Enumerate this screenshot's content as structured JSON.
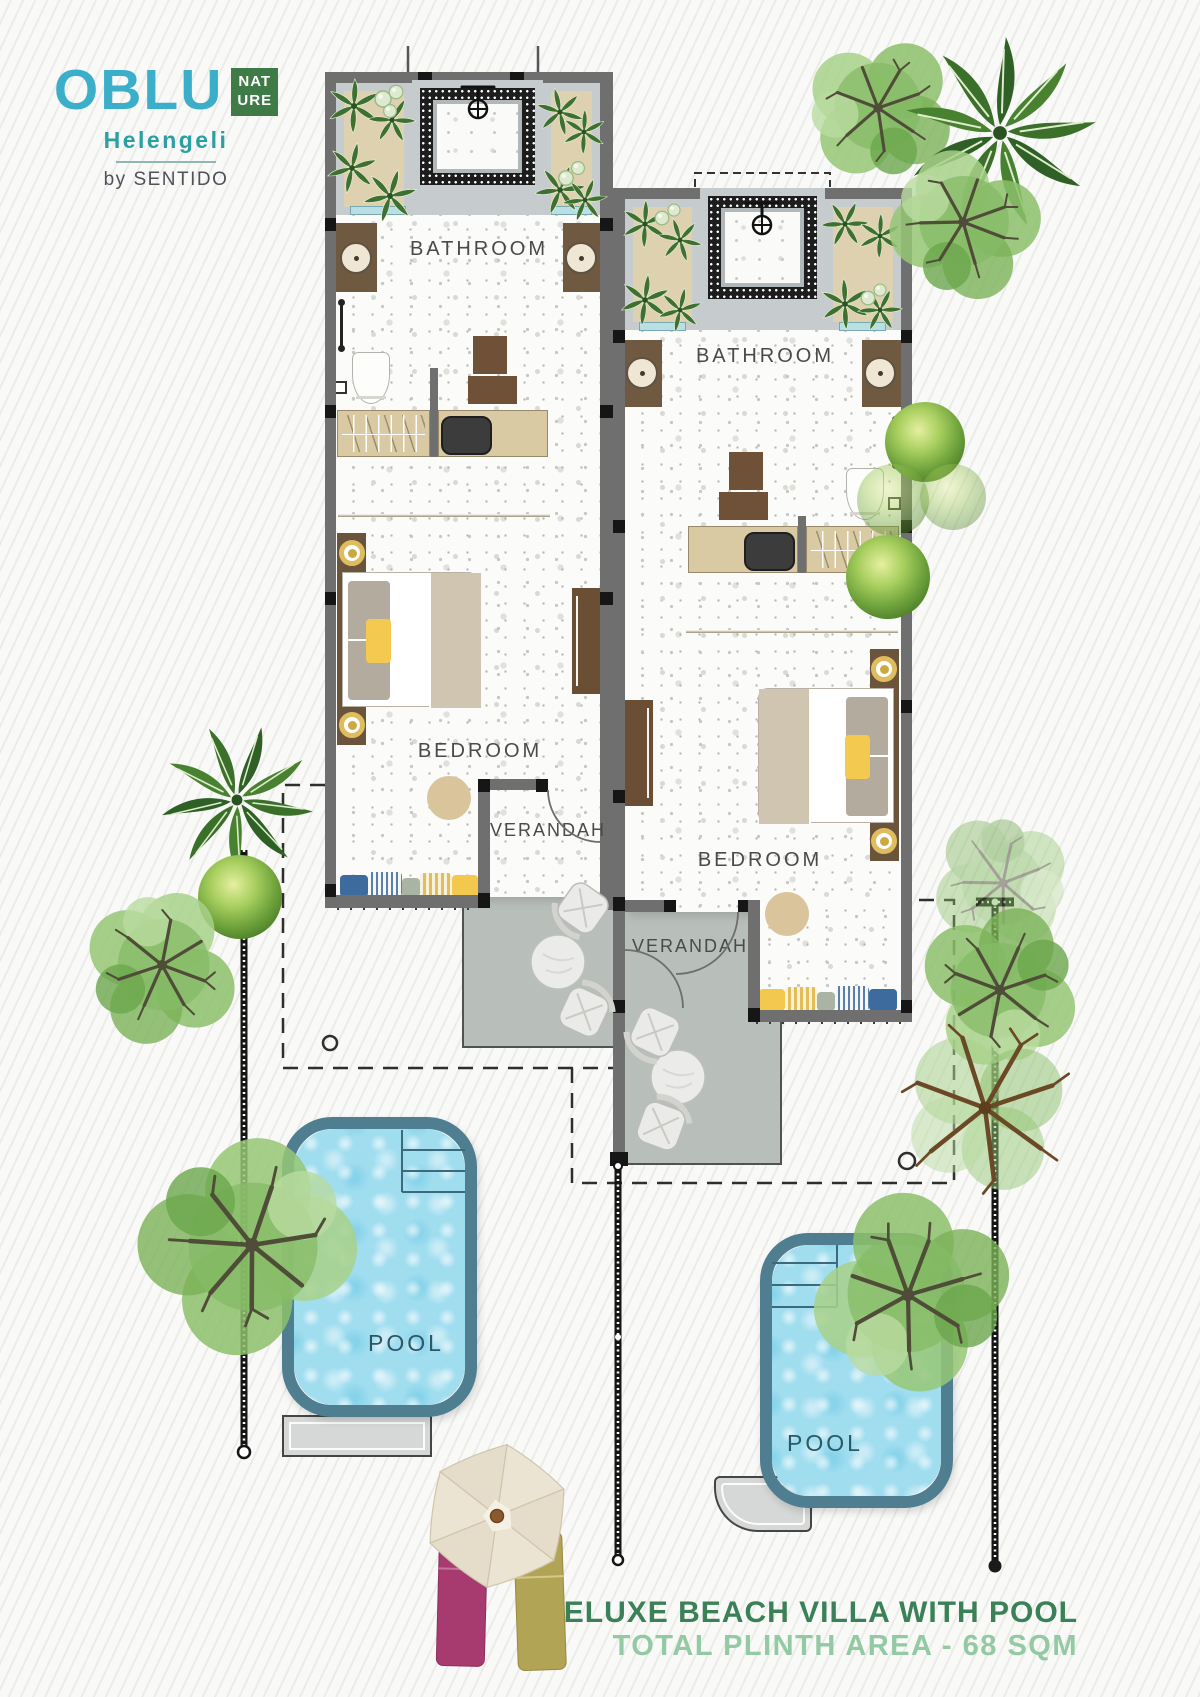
{
  "logo": {
    "brand": "OBLU",
    "badge": {
      "line1": "NAT",
      "line2": "URE"
    },
    "property": "Helengeli",
    "byline": "by SENTIDO"
  },
  "villas": [
    {
      "name": "left-villa",
      "bathroom": "BATHROOM",
      "bedroom": "BEDROOM",
      "verandah": "VERANDAH",
      "pool": "POOL"
    },
    {
      "name": "right-villa",
      "bathroom": "BATHROOM",
      "bedroom": "BEDROOM",
      "verandah": "VERANDAH",
      "pool": "POOL"
    }
  ],
  "footer": {
    "title": "DELUXE BEACH VILLA WITH POOL",
    "subtitle": "TOTAL PLINTH AREA - 68 SQM"
  },
  "colors": {
    "brand_teal": "#3bafc9",
    "badge_green": "#3e7b46",
    "property_teal": "#2ba0a4",
    "byline_gray": "#50525a",
    "title_green": "#3a8157",
    "subtitle_green": "#93caa4",
    "pool_water": "#a0ddef",
    "pool_edge": "#4f7e90",
    "wall_gray": "#6f6f6f",
    "deck_gray": "#b8beba",
    "planter_beige": "#ddd1b0",
    "room_label_gray": "#4a4a4a"
  }
}
